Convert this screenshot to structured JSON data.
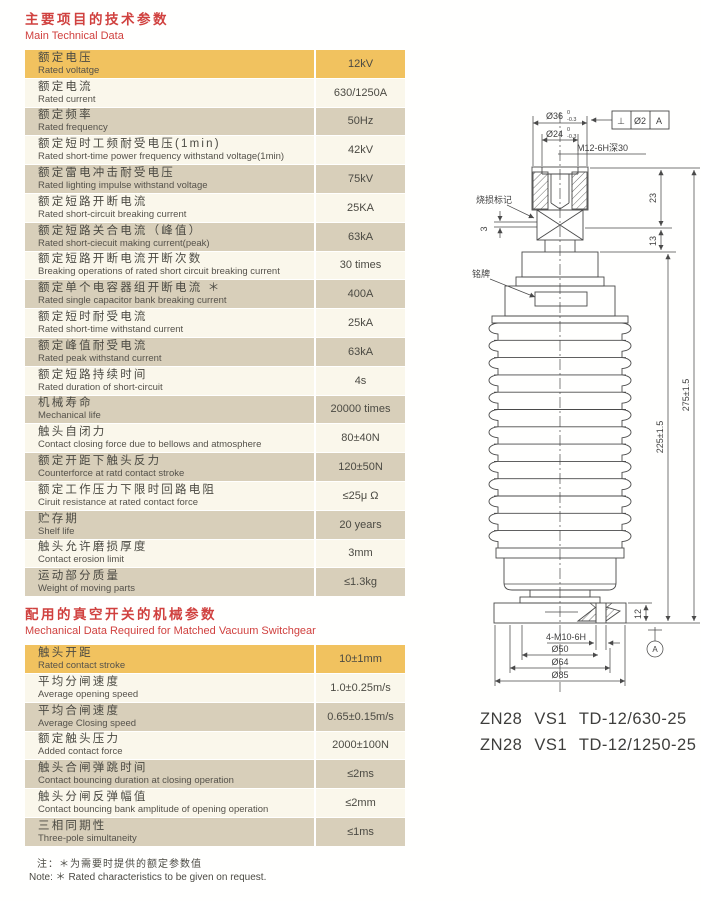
{
  "colors": {
    "header_red": "#d0413f",
    "row_orange": "#f1c25f",
    "row_cream": "#faf7eb",
    "row_tan": "#d8cfba",
    "line": "#4a4a4a",
    "text": "#4b4a43"
  },
  "section1": {
    "title_zh": "主要项目的技术参数",
    "title_en": "Main Technical Data",
    "rows": [
      {
        "zh": "额定电压",
        "en": "Rated voltatge",
        "value": "12kV"
      },
      {
        "zh": "额定电流",
        "en": "Rated current",
        "value": "630/1250A"
      },
      {
        "zh": "额定频率",
        "en": "Rated frequency",
        "value": "50Hz"
      },
      {
        "zh": "额定短时工频耐受电压(1min)",
        "en": "Rated short-time power frequency withstand voltage(1min)",
        "value": "42kV"
      },
      {
        "zh": "额定雷电冲击耐受电压",
        "en": "Rated lighting impulse withstand voltage",
        "value": "75kV"
      },
      {
        "zh": "额定短路开断电流",
        "en": "Rated short-circuit breaking current",
        "value": "25KA"
      },
      {
        "zh": "额定短路关合电流（峰值）",
        "en": "Rated short-ciecuit making current(peak)",
        "value": "63kA"
      },
      {
        "zh": "额定短路开断电流开断次数",
        "en": "Breaking operations of rated short circuit breaking current",
        "value": "30 times"
      },
      {
        "zh": "额定单个电容器组开断电流 ＊",
        "en": "Rated single capacitor bank breaking current",
        "value": "400A"
      },
      {
        "zh": "额定短时耐受电流",
        "en": "Rated short-time withstand current",
        "value": "25kA"
      },
      {
        "zh": "额定峰值耐受电流",
        "en": "Rated peak withstand current",
        "value": "63kA"
      },
      {
        "zh": "额定短路持续时间",
        "en": "Rated duration of short-circuit",
        "value": "4s"
      },
      {
        "zh": "机械寿命",
        "en": "Mechanical life",
        "value": "20000 times"
      },
      {
        "zh": "触头自闭力",
        "en": "Contact closing force due to bellows and atmosphere",
        "value": "80±40N"
      },
      {
        "zh": "额定开距下触头反力",
        "en": "Counterforce at ratd contact stroke",
        "value": "120±50N"
      },
      {
        "zh": "额定工作压力下限时回路电阻",
        "en": "Ciruit resistance at rated contact force",
        "value": "≤25μ Ω"
      },
      {
        "zh": "贮存期",
        "en": "Shelf life",
        "value": "20 years"
      },
      {
        "zh": "触头允许磨损厚度",
        "en": "Contact erosion limit",
        "value": "3mm"
      },
      {
        "zh": "运动部分质量",
        "en": "Weight of moving parts",
        "value": "≤1.3kg"
      }
    ]
  },
  "section2": {
    "title_zh": "配用的真空开关的机械参数",
    "title_en": "Mechanical Data Required for Matched Vacuum Switchgear",
    "rows": [
      {
        "zh": "触头开距",
        "en": "Rated contact stroke",
        "value": "10±1mm"
      },
      {
        "zh": "平均分闸速度",
        "en": "Average opening speed",
        "value": "1.0±0.25m/s"
      },
      {
        "zh": "平均合闸速度",
        "en": "Average Closing speed",
        "value": "0.65±0.15m/s"
      },
      {
        "zh": "额定触头压力",
        "en": "Added contact force",
        "value": "2000±100N"
      },
      {
        "zh": "触头合闸弹跳时间",
        "en": "Contact bouncing duration at closing operation",
        "value": "≤2ms"
      },
      {
        "zh": "触头分闸反弹幅值",
        "en": "Contact bouncing bank amplitude of opening operation",
        "value": "≤2mm"
      },
      {
        "zh": "三相同期性",
        "en": "Three-pole simultaneity",
        "value": "≤1ms"
      }
    ]
  },
  "note": {
    "zh": "注：＊为需要时提供的额定参数值",
    "en": "Note: ＊ Rated characteristics to be given on request."
  },
  "drawing": {
    "dims": {
      "d36": "Ø36",
      "d24": "Ø24",
      "tol_hi": "0",
      "tol_lo": "-0.3",
      "thread_top": "M12-6H深30",
      "gdt_sym": "⊥",
      "gdt_tol": "Ø2",
      "gdt_datum": "A",
      "burn_mark": "烧损标记",
      "gap3": "3",
      "nameplate": "铭牌",
      "h23": "23",
      "h13": "13",
      "h225": "225±1.5",
      "h275": "275±1.5",
      "h12": "12",
      "datum_a": "A",
      "bolt": "4-M10-6H",
      "d50": "Ø50",
      "d64": "Ø64",
      "d85": "Ø85"
    },
    "models": [
      "ZN28 VS1 TD-12/630-25",
      "ZN28 VS1 TD-12/1250-25"
    ]
  }
}
